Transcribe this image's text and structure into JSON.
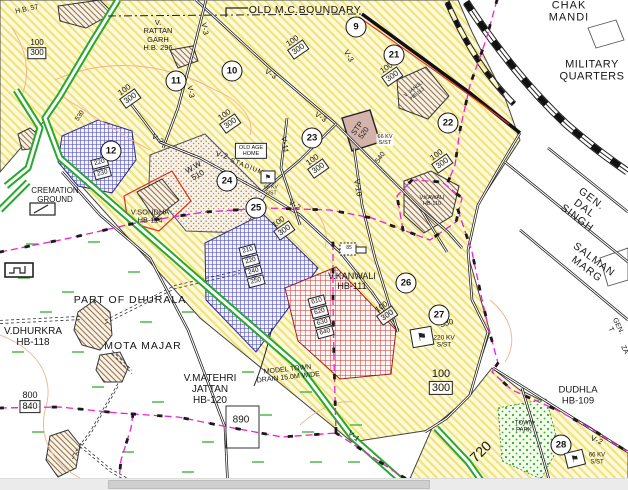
{
  "map": {
    "colors": {
      "yellow_zone_hatch": "#f2e377",
      "yellow_zone_bg": "#fdf9dd",
      "blue_zone": "#4343ae",
      "red_zone": "#cf3030",
      "green_road": "#28a82e",
      "magenta_drain": "#ee22cc",
      "boundary_red": "#e03020",
      "village_hatch": "#8f6f4c"
    },
    "area_labels": [
      {
        "n": "label-hb57",
        "t": "H.B. 57",
        "x": 27,
        "y": 10,
        "s": 7,
        "r": -12
      },
      {
        "n": "label-old-mc-boundary",
        "t": "OLD M.C.BOUNDARY",
        "x": 305,
        "y": 11,
        "s": 10.5,
        "ls": 0.4
      },
      {
        "n": "label-chak-mandi",
        "t": "CHAK MANDI",
        "x": 569,
        "y": 12,
        "s": 11,
        "ls": 1
      },
      {
        "n": "label-military-quarters",
        "t": "MILITARY\nQUARTERS",
        "x": 592,
        "y": 71,
        "s": 11,
        "ls": 0.5
      },
      {
        "n": "label-rattan-garh",
        "t": "V.\nRATTAN\nGARH\nH.B. 296",
        "x": 158,
        "y": 36,
        "s": 7.5
      },
      {
        "n": "label-cremation-ground",
        "t": "CREMATION\nGROUND",
        "x": 55,
        "y": 196,
        "s": 8
      },
      {
        "n": "label-v-sondha",
        "t": "V.SONDHA\nHB-114",
        "x": 150,
        "y": 217,
        "s": 7.5
      },
      {
        "n": "label-v-kanwali",
        "t": "V.KANWALI\nHB-111",
        "x": 352,
        "y": 281,
        "s": 9
      },
      {
        "n": "label-v-kawali",
        "t": "V.KAWALI\nHB-110",
        "x": 432,
        "y": 201,
        "s": 5.5
      },
      {
        "n": "label-v-jandli",
        "t": "V. JANDLI\nHB-113",
        "x": 416,
        "y": 92,
        "s": 5,
        "r": -38
      },
      {
        "n": "label-gen-dal-singh",
        "t": "GEN. DAL SINGH",
        "x": 584,
        "y": 209,
        "s": 10.5,
        "r": 37,
        "ls": 1
      },
      {
        "n": "label-salman-marg",
        "t": "SALMAN MARG",
        "x": 590,
        "y": 265,
        "s": 10.5,
        "r": 37,
        "ls": 1
      },
      {
        "n": "label-gen-t",
        "t": "GEN. T",
        "x": 614,
        "y": 328,
        "s": 7,
        "r": 64
      },
      {
        "n": "label-za",
        "t": "ZA",
        "x": 624,
        "y": 350,
        "s": 7,
        "r": 64
      },
      {
        "n": "label-dudhla",
        "t": "DUDHLA\nHB-109",
        "x": 578,
        "y": 396,
        "s": 9.5
      },
      {
        "n": "label-town-park",
        "t": "TOWN\nPARK",
        "x": 524,
        "y": 427,
        "s": 6
      },
      {
        "n": "label-720",
        "t": "720",
        "x": 481,
        "y": 452,
        "s": 14,
        "r": -45
      },
      {
        "n": "label-530-substation",
        "t": "530",
        "x": 447,
        "y": 324,
        "s": 8,
        "r": -15
      },
      {
        "n": "label-220kv-sst",
        "t": "220 KV\nS/ST",
        "x": 444,
        "y": 342,
        "s": 6.5
      },
      {
        "n": "label-66kv-sst-28",
        "t": "66 KV\nS/ST",
        "x": 597,
        "y": 459,
        "s": 6
      },
      {
        "n": "label-66kv-sst-stp",
        "t": "66 KV\nS/ST",
        "x": 385,
        "y": 140,
        "s": 5.5,
        "bg": 1
      },
      {
        "n": "label-540",
        "t": "540",
        "x": 381,
        "y": 158,
        "s": 7,
        "r": -55
      },
      {
        "n": "label-stp-520",
        "t": "STP\n520",
        "x": 361,
        "y": 131,
        "s": 7.5,
        "r": -55
      },
      {
        "n": "label-ww-510",
        "t": "W.W\n510",
        "x": 196,
        "y": 172,
        "s": 8,
        "r": -30
      },
      {
        "n": "label-stadium",
        "t": "STADIUM",
        "x": 247,
        "y": 167,
        "s": 6.5,
        "r": 22,
        "ls": 1
      },
      {
        "n": "label-66kv-sst-stadium",
        "t": "66 KV\nS/ST",
        "x": 271,
        "y": 191,
        "s": 5
      },
      {
        "n": "label-old-age-home",
        "t": "OLD AGE\nHOME",
        "x": 251,
        "y": 151,
        "s": 5.5,
        "boxed": 1
      },
      {
        "n": "label-part-of-dhurala",
        "t": "PART OF DHURALA",
        "x": 130,
        "y": 301,
        "s": 10.5,
        "ls": 1
      },
      {
        "n": "label-v-dhurkra",
        "t": "V.DHURKRA\nHB-118",
        "x": 33,
        "y": 337,
        "s": 10
      },
      {
        "n": "label-mota-majar",
        "t": "MOTA MAJAR",
        "x": 143,
        "y": 347,
        "s": 10.5,
        "ls": 1
      },
      {
        "n": "label-v-matehri",
        "t": "V.MATEHRI\nJATTAN\nHB-120",
        "x": 210,
        "y": 390,
        "s": 10
      },
      {
        "n": "label-model-town-drain",
        "t": "MODEL TOWN\nDRAIN 15.0M WIDE",
        "x": 288,
        "y": 374,
        "s": 7,
        "r": -6
      },
      {
        "n": "label-890",
        "t": "890",
        "x": 241,
        "y": 420,
        "s": 10
      },
      {
        "n": "label-530-circle12",
        "t": "530",
        "x": 80,
        "y": 116,
        "s": 6.5,
        "r": -55
      },
      {
        "n": "label-plot-85",
        "t": "85",
        "x": 349,
        "y": 249,
        "s": 5
      }
    ],
    "road_labels": [
      {
        "t": "V-3",
        "x": 205,
        "y": 29,
        "r": 78
      },
      {
        "t": "V-3",
        "x": 271,
        "y": 74,
        "r": 33
      },
      {
        "t": "V-3",
        "x": 191,
        "y": 92,
        "r": 78
      },
      {
        "t": "V-3",
        "x": 349,
        "y": 56,
        "r": 60
      },
      {
        "t": "V-3",
        "x": 321,
        "y": 117,
        "r": 33
      },
      {
        "t": "V-2",
        "x": 158,
        "y": 139,
        "r": 33
      },
      {
        "t": "V-2",
        "x": 222,
        "y": 155,
        "r": 15
      },
      {
        "t": "V-2",
        "x": 295,
        "y": 205,
        "r": 33
      },
      {
        "t": "V-2",
        "x": 597,
        "y": 440,
        "r": 22
      },
      {
        "t": "V-11",
        "x": 285,
        "y": 145,
        "r": 83
      },
      {
        "t": "V-10",
        "x": 358,
        "y": 188,
        "r": 80
      },
      {
        "t": "V-1",
        "x": 354,
        "y": 436,
        "r": 40
      }
    ],
    "plot_ratio_labels": [
      {
        "a": "100",
        "b": "300",
        "x": 37,
        "y": 49,
        "r": 0,
        "s": 8
      },
      {
        "a": "100",
        "b": "300",
        "x": 128,
        "y": 95,
        "r": -35,
        "s": 8
      },
      {
        "a": "100",
        "b": "300",
        "x": 228,
        "y": 120,
        "r": -35,
        "s": 8
      },
      {
        "a": "100",
        "b": "300",
        "x": 296,
        "y": 46,
        "r": -35,
        "s": 8
      },
      {
        "a": "100",
        "b": "300",
        "x": 390,
        "y": 73,
        "r": -35,
        "s": 8
      },
      {
        "a": "100",
        "b": "300",
        "x": 440,
        "y": 160,
        "r": -35,
        "s": 8
      },
      {
        "a": "100",
        "b": "300",
        "x": 282,
        "y": 227,
        "r": -35,
        "s": 8
      },
      {
        "a": "100",
        "b": "300",
        "x": 316,
        "y": 165,
        "r": -35,
        "s": 8
      },
      {
        "a": "100",
        "b": "300",
        "x": 385,
        "y": 312,
        "r": -35,
        "s": 8
      },
      {
        "a": "100",
        "b": "300",
        "x": 441,
        "y": 382,
        "r": 0,
        "s": 11
      },
      {
        "a": "800",
        "b": "840",
        "x": 30,
        "y": 402,
        "r": 0,
        "s": 9
      }
    ],
    "plot_number_stacks": [
      {
        "n": "plot-stack-blue-central",
        "v": [
          "210",
          "220",
          "240",
          "250"
        ],
        "x": 252,
        "y": 266,
        "r": -15
      },
      {
        "n": "plot-stack-blue-12",
        "v": [
          "220",
          "230"
        ],
        "x": 101,
        "y": 168,
        "r": -15
      },
      {
        "n": "plot-stack-red",
        "v": [
          "610",
          "620",
          "630",
          "640"
        ],
        "x": 321,
        "y": 317,
        "r": -15
      }
    ],
    "numbered_circles": [
      {
        "n": "9",
        "x": 356,
        "y": 27
      },
      {
        "n": "10",
        "x": 232,
        "y": 71
      },
      {
        "n": "11",
        "x": 176,
        "y": 81
      },
      {
        "n": "12",
        "x": 111,
        "y": 151
      },
      {
        "n": "21",
        "x": 394,
        "y": 55
      },
      {
        "n": "22",
        "x": 448,
        "y": 123
      },
      {
        "n": "23",
        "x": 312,
        "y": 138
      },
      {
        "n": "24",
        "x": 227,
        "y": 181
      },
      {
        "n": "25",
        "x": 256,
        "y": 208
      },
      {
        "n": "26",
        "x": 406,
        "y": 283
      },
      {
        "n": "27",
        "x": 439,
        "y": 315
      },
      {
        "n": "28",
        "x": 561,
        "y": 445
      }
    ],
    "substation_flags": [
      {
        "x": 422,
        "y": 337,
        "s": 20,
        "r": -10
      },
      {
        "x": 575,
        "y": 459,
        "s": 17,
        "r": -14
      },
      {
        "x": 268,
        "y": 177,
        "s": 13,
        "r": 0
      }
    ]
  },
  "viewer": {
    "horizontal_scrollbar": {
      "thumb_left_px": 108,
      "thumb_width_px": 322
    }
  }
}
